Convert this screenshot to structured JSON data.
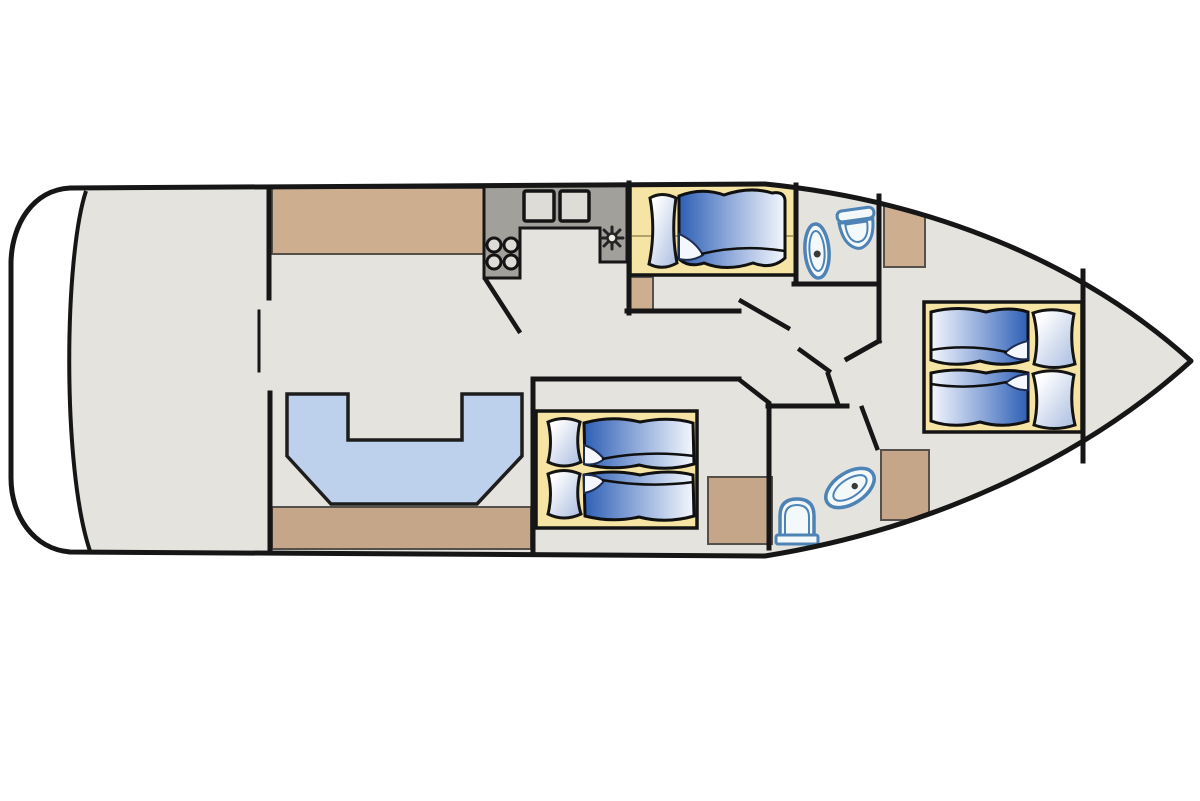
{
  "diagram_type": "boat-floor-plan",
  "colors": {
    "background": "#ffffff",
    "wall": "#161616",
    "hull_line": "#161616",
    "deck": "#e4e3de",
    "platform": "#ffffff",
    "wood": "#cdaf90",
    "wood_dark": "#c5a689",
    "counter": "#a2a09b",
    "counter_inset": "#dddcd7",
    "mattress": "#f5e4a4",
    "mattress_line": "#9c8a55",
    "sofa": "#bed1ec",
    "bed_dark": "#2e5fb5",
    "bed_mid": "#8aa6d8",
    "bed_light": "#f4f7fd",
    "pillow_tint": "#a9bce0",
    "pillow_light": "#ffffff",
    "fixture": "#4d83b5",
    "fixture_fill": "#f3f8fb",
    "dot": "#3a3a3a",
    "outline": "#1a1a1a"
  },
  "components": [
    "hull",
    "swim-platform",
    "aft-deck",
    "salon-sideboard",
    "u-shaped-sofa",
    "aft-cabinet-strip",
    "galley-counter",
    "stove-burners",
    "galley-sink",
    "counter-hatches",
    "guest-cabin-mattress",
    "guest-bed",
    "upper-bathroom-toilet",
    "upper-bathroom-sink",
    "mid-cabin-mattress",
    "mid-cabin-twin-beds",
    "lower-bathroom-toilet",
    "lower-bathroom-sink",
    "bow-cabin-mattress",
    "bow-cabin-twin-beds",
    "wardrobe-cabinets",
    "interior-walls",
    "door-swings"
  ]
}
